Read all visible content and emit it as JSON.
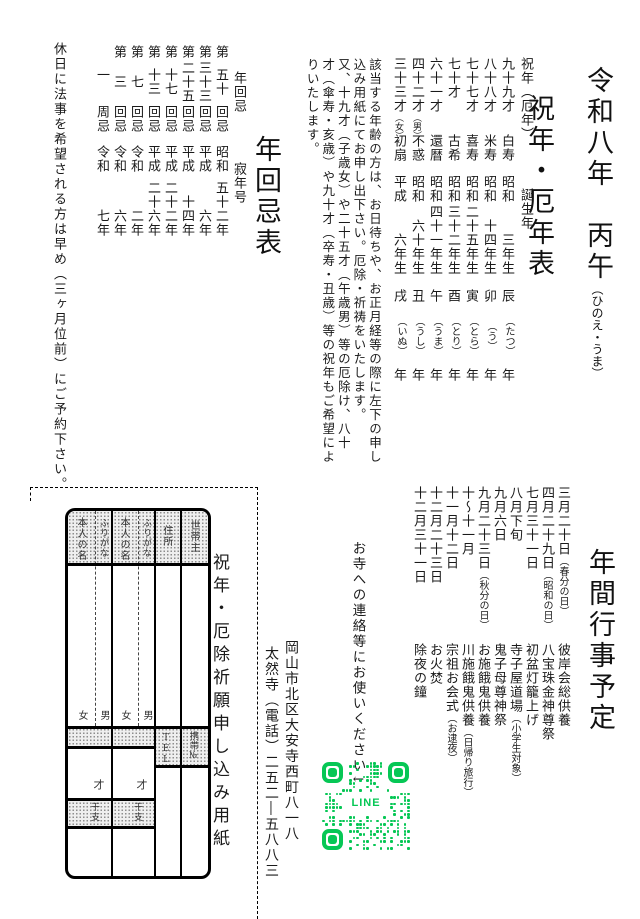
{
  "header": {
    "era_title": "令和八年　丙午",
    "era_ruby": "（ひのえ・うま）",
    "subtitle": "祝年・厄年表"
  },
  "age_table": {
    "header": {
      "top": "祝年（厄年）",
      "bottom": "誕生年"
    },
    "rows": [
      {
        "age": "九十九才",
        "gender": "",
        "name": "白寿",
        "birth": [
          "昭和",
          "三年生"
        ],
        "zodiac": [
          "辰",
          "（たつ）",
          "年"
        ]
      },
      {
        "age": "八十八才",
        "gender": "",
        "name": "米寿",
        "birth": [
          "昭和",
          "十四年生"
        ],
        "zodiac": [
          "卯",
          "（う）",
          "年"
        ]
      },
      {
        "age": "七十七才",
        "gender": "",
        "name": "喜寿",
        "birth": [
          "昭和",
          "二十五年生"
        ],
        "zodiac": [
          "寅",
          "（とら）",
          "年"
        ]
      },
      {
        "age": "七十才",
        "gender": "",
        "name": "古希",
        "birth": [
          "昭和",
          "三十二年生"
        ],
        "zodiac": [
          "酉",
          "（とり）",
          "年"
        ]
      },
      {
        "age": "六十一才",
        "gender": "",
        "name": "還暦",
        "birth": [
          "昭和",
          "四十一年生"
        ],
        "zodiac": [
          "午",
          "（うま）",
          "年"
        ]
      },
      {
        "age": "四十二才",
        "gender": "（男）",
        "name": "不惑",
        "birth": [
          "昭和",
          "六十年生"
        ],
        "zodiac": [
          "丑",
          "（うし）",
          "年"
        ]
      },
      {
        "age": "三十三才",
        "gender": "（女）",
        "name": "初扇",
        "birth": [
          "平成",
          "六年生"
        ],
        "zodiac": [
          "戌",
          "（いぬ）",
          "年"
        ]
      }
    ]
  },
  "notice_lines": [
    "該当する年齢の方は、お日待ちや、お正月経等の際に左下の申し",
    "込み用紙にてお申し出下さい。厄除・祈祷をいたします。",
    "又、十九才（子歳女）や二十五才（午歳男）等の厄除け、八十",
    "才（傘寿・亥歳）や九十才（卒寿・丑歳）等の祝年もご希望によ",
    "りいたします。"
  ],
  "kaiki": {
    "title": "年回忌表",
    "header_top": "年回忌",
    "header_bottom": "寂年号",
    "rows": [
      {
        "kaiki": [
          "第",
          "五十",
          "回忌"
        ],
        "year": [
          "昭和",
          "五十二年"
        ]
      },
      {
        "kaiki": [
          "第",
          "三十三",
          "回忌"
        ],
        "year": [
          "平成",
          "六年"
        ]
      },
      {
        "kaiki": [
          "第",
          "二十五",
          "回忌"
        ],
        "year": [
          "平成",
          "十四年"
        ]
      },
      {
        "kaiki": [
          "第",
          "十七",
          "回忌"
        ],
        "year": [
          "平成",
          "二十二年"
        ]
      },
      {
        "kaiki": [
          "第",
          "十三",
          "回忌"
        ],
        "year": [
          "平成",
          "二十六年"
        ]
      },
      {
        "kaiki": [
          "第",
          "七",
          "回忌"
        ],
        "year": [
          "令和",
          "二年"
        ]
      },
      {
        "kaiki": [
          "第",
          "三",
          "回忌"
        ],
        "year": [
          "令和",
          "六年"
        ]
      },
      {
        "kaiki": [
          "",
          "一",
          "周忌"
        ],
        "year": [
          "令和",
          "七年"
        ]
      }
    ]
  },
  "holiday_note": "休日に法事を希望される方は早め（三ヶ月位前）にご予約下さい。",
  "events": {
    "title": "年間行事予定",
    "items": [
      {
        "date": "三月二十日",
        "date_note": "（春分の日）",
        "name": "彼岸会総供養",
        "name_note": ""
      },
      {
        "date": "四月二十九日",
        "date_note": "（昭和の日）",
        "name": "八宝珠金神尊祭",
        "name_note": ""
      },
      {
        "date": "七月三十一日",
        "date_note": "",
        "name": "初盆灯籠上げ",
        "name_note": ""
      },
      {
        "date": "八月下旬",
        "date_note": "",
        "name": "寺子屋道場",
        "name_note": "（小学生対象）"
      },
      {
        "date": "九月六日",
        "date_note": "",
        "name": "鬼子母尊神祭",
        "name_note": ""
      },
      {
        "date": "九月二十三日",
        "date_note": "（秋分の日）",
        "name": "お施餓鬼供養",
        "name_note": ""
      },
      {
        "date": "十～十一月",
        "date_note": "",
        "name": "川施餓鬼供養",
        "name_note": "（日帰り旅行）"
      },
      {
        "date": "十一月十二日",
        "date_note": "",
        "name": "宗祖お会式",
        "name_note": "（お逮夜）"
      },
      {
        "date": "十二月二十三日",
        "date_note": "",
        "name": "お火焚",
        "name_note": ""
      },
      {
        "date": "十二月三十一日",
        "date_note": "",
        "name": "除夜の鐘",
        "name_note": ""
      }
    ]
  },
  "line_note": "お寺への連絡等にお使いください↓",
  "qr_label": "LINE",
  "address": {
    "line1": "岡山市北区大安寺西町八一八",
    "line2": "太然寺（電話）二五二―五八八三"
  },
  "form": {
    "title": "祝年・厄除祈願申し込み用紙",
    "name_label": "本人の名",
    "furigana_label": "ふりがな",
    "address_label": "住所",
    "householder_label": "世帯主",
    "female": "女",
    "male": "男",
    "age_label": "才",
    "zodiac_label": "干支",
    "tel_label": "TEL",
    "mobile_label": "携帯№"
  },
  "colors": {
    "qr_green": "#06c755",
    "ink": "#1a1a1a"
  }
}
